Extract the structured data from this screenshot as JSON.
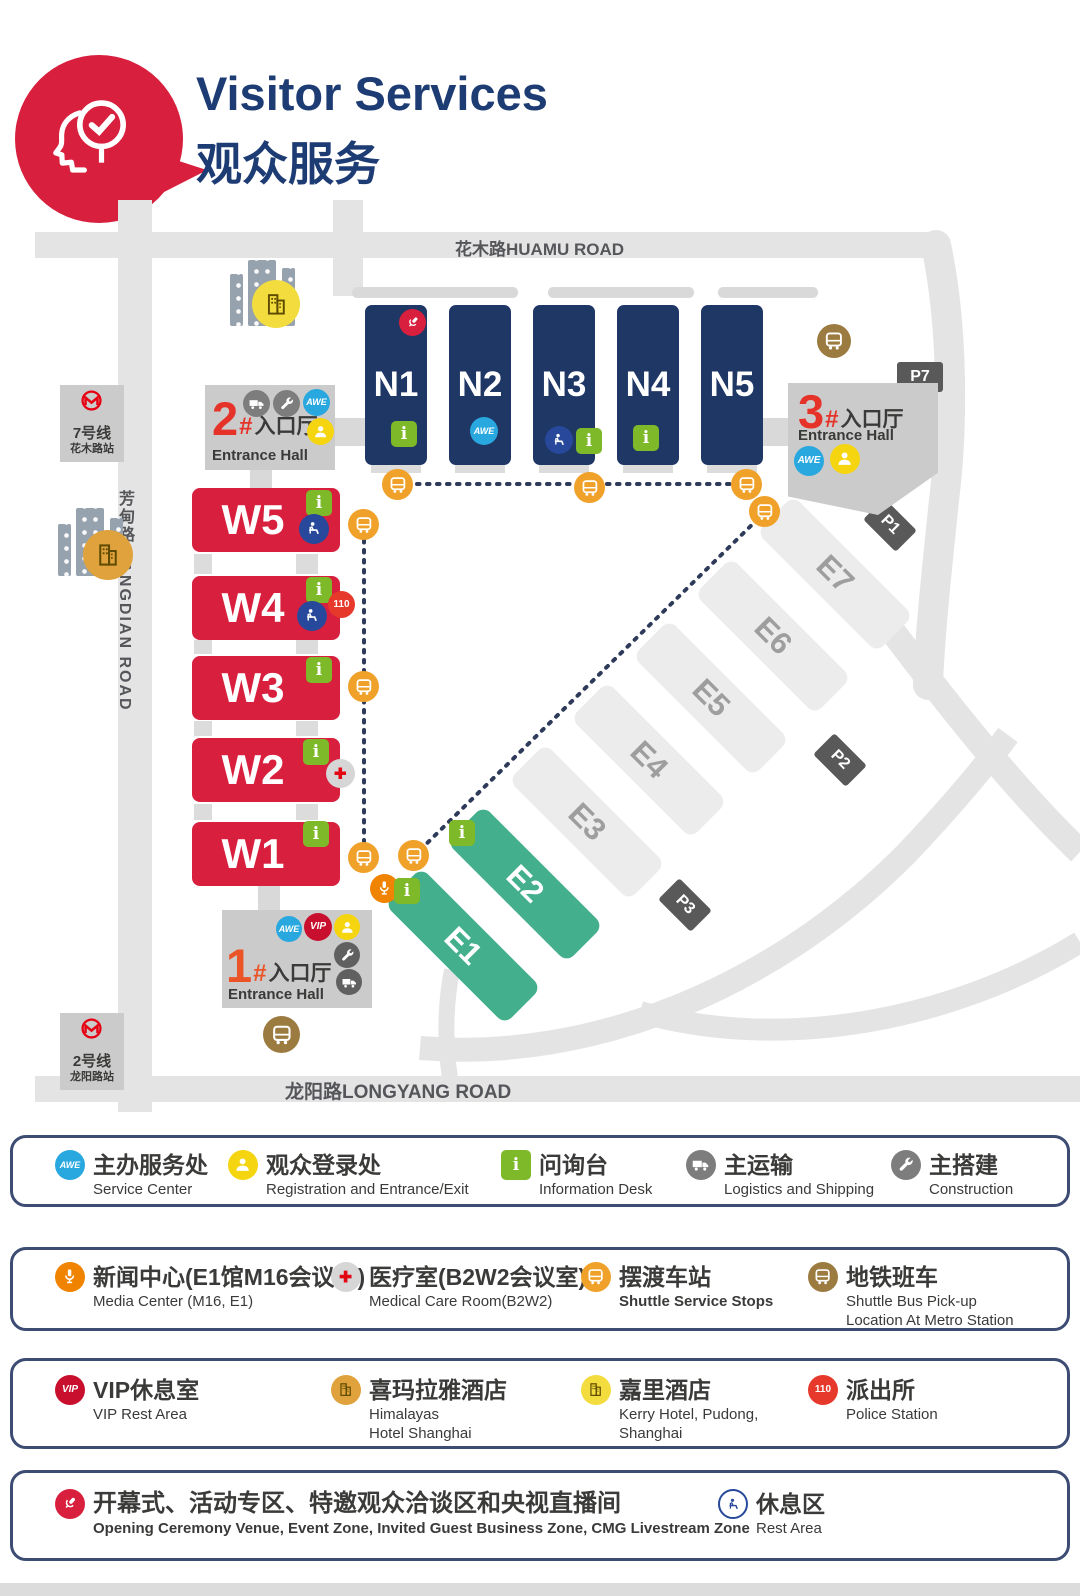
{
  "header": {
    "title": "Visitor Services",
    "subtitle": "观众服务"
  },
  "icons": {
    "awe": "AWE",
    "vip": "VIP",
    "police": "110",
    "info": "i"
  },
  "colors": {
    "navy_hall": "#1F3765",
    "red_hall": "#D81F3E",
    "green_hall": "#43AF8C",
    "title_navy": "#1E3C74",
    "entrance_red": "#E6332A",
    "entrance_orange": "#EB5427",
    "awe_blue": "#29A8E0",
    "info_green": "#7DB928",
    "registration_yellow": "#F5D410",
    "shuttle_orange": "#F0A12A",
    "metro_shuttle_brown": "#9C7B40",
    "media_orange": "#F08300",
    "police_red": "#E6392B",
    "vip_red": "#C8102E",
    "rest_blue": "#27489B",
    "metro_logo_red": "#E60012",
    "road_gray": "#E4E4E4"
  },
  "map": {
    "roads": {
      "huamu": "花木路HUAMU ROAD",
      "fangdian": "芳甸路 FANGDIAN ROAD",
      "longyang": "龙阳路LONGYANG ROAD"
    },
    "metro": [
      {
        "line": "7号线",
        "station": "花木路站"
      },
      {
        "line": "2号线",
        "station": "龙阳路站"
      }
    ],
    "halls": {
      "n1": "N1",
      "n2": "N2",
      "n3": "N3",
      "n4": "N4",
      "n5": "N5",
      "w1": "W1",
      "w2": "W2",
      "w3": "W3",
      "w4": "W4",
      "w5": "W5",
      "e1": "E1",
      "e2": "E2",
      "e3": "E3",
      "e4": "E4",
      "e5": "E5",
      "e6": "E6",
      "e7": "E7"
    },
    "parking": {
      "p1": "P1",
      "p2": "P2",
      "p3": "P3",
      "p7": "P7"
    },
    "entrances": [
      {
        "num": "1",
        "hash": "#",
        "zh": "入口厅",
        "en": "Entrance Hall"
      },
      {
        "num": "2",
        "hash": "#",
        "zh": "入口厅",
        "en": "Entrance Hall"
      },
      {
        "num": "3",
        "hash": "#",
        "zh": "入口厅",
        "en": "Entrance Hall"
      }
    ]
  },
  "legend": {
    "rows": [
      {
        "items": [
          {
            "icon": "awe-badge",
            "zh": "主办服务处",
            "en": "Service Center"
          },
          {
            "icon": "registration",
            "zh": "观众登录处",
            "en": "Registration and Entrance/Exit"
          },
          {
            "icon": "information",
            "zh": "问询台",
            "en": "Information Desk"
          },
          {
            "icon": "logistics",
            "zh": "主运输",
            "en": "Logistics and Shipping"
          },
          {
            "icon": "construction",
            "zh": "主搭建",
            "en": "Construction"
          }
        ]
      },
      {
        "items": [
          {
            "icon": "media-center",
            "zh": "新闻中心(E1馆M16会议室)",
            "en": "Media Center (M16, E1)"
          },
          {
            "icon": "medical",
            "zh": "医疗室(B2W2会议室)",
            "en": "Medical Care Room(B2W2)"
          },
          {
            "icon": "shuttle-stop",
            "zh": "摆渡车站",
            "en": "Shuttle Service Stops"
          },
          {
            "icon": "metro-shuttle",
            "zh": "地铁班车",
            "en": "Shuttle Bus Pick-up\nLocation At Metro Station"
          }
        ]
      },
      {
        "items": [
          {
            "icon": "vip-badge",
            "zh": "VIP休息室",
            "en": "VIP Rest Area"
          },
          {
            "icon": "himalayas-hotel",
            "zh": "喜玛拉雅酒店",
            "en": "Himalayas\nHotel Shanghai"
          },
          {
            "icon": "kerry-hotel",
            "zh": "嘉里酒店",
            "en": "Kerry Hotel, Pudong,\nShanghai"
          },
          {
            "icon": "police-badge",
            "zh": "派出所",
            "en": "Police Station"
          }
        ]
      },
      {
        "items": [
          {
            "icon": "opening-ceremony",
            "zh": "开幕式、活动专区、特邀观众洽谈区和央视直播间",
            "en": "Opening Ceremony Venue, Event Zone, Invited Guest Business Zone, CMG Livestream Zone"
          },
          {
            "icon": "rest-area",
            "zh": "休息区",
            "en": "Rest Area"
          }
        ]
      }
    ]
  }
}
